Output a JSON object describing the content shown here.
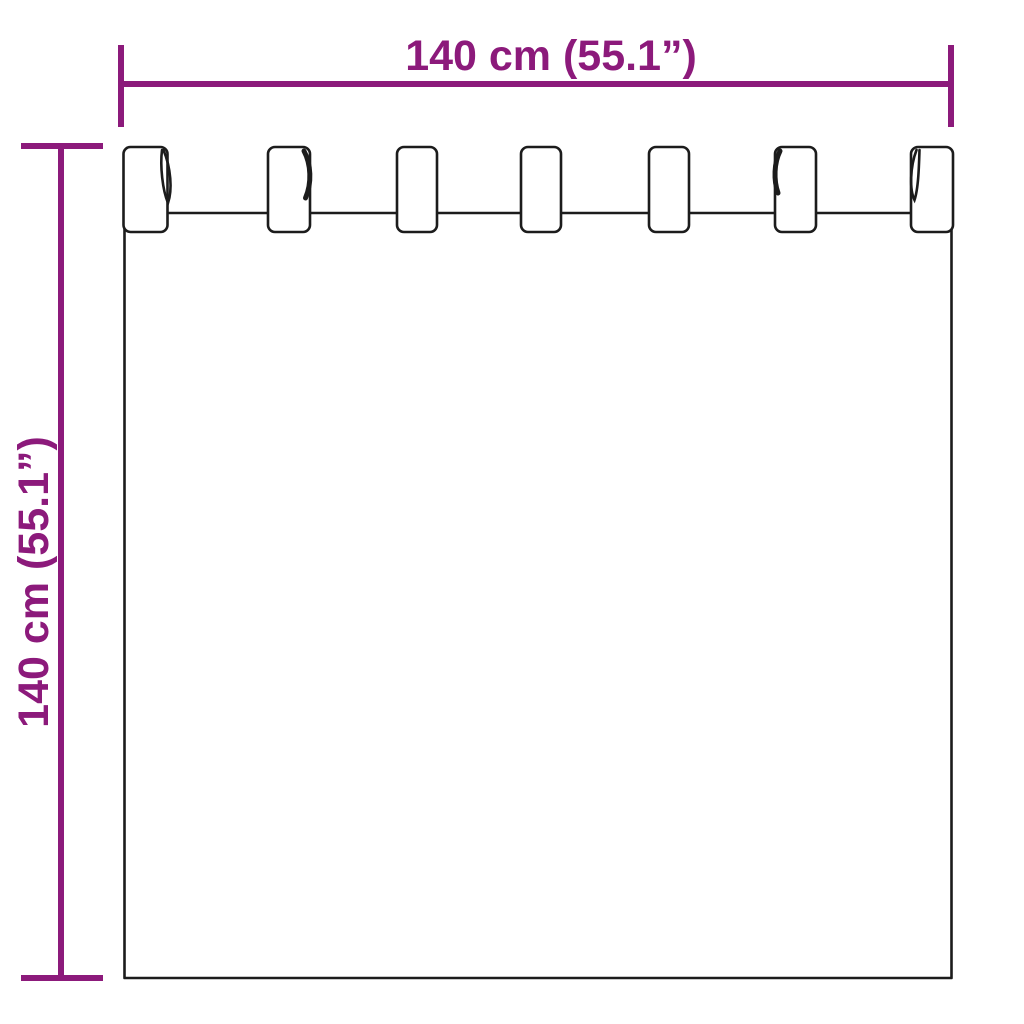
{
  "diagram": {
    "width_label": "140 cm (55.1”)",
    "height_label": "140 cm (55.1”)",
    "accent_color": "#8c1a7b",
    "outline_color": "#1c1c1c",
    "background_color": "#ffffff",
    "tab_count": "7"
  }
}
